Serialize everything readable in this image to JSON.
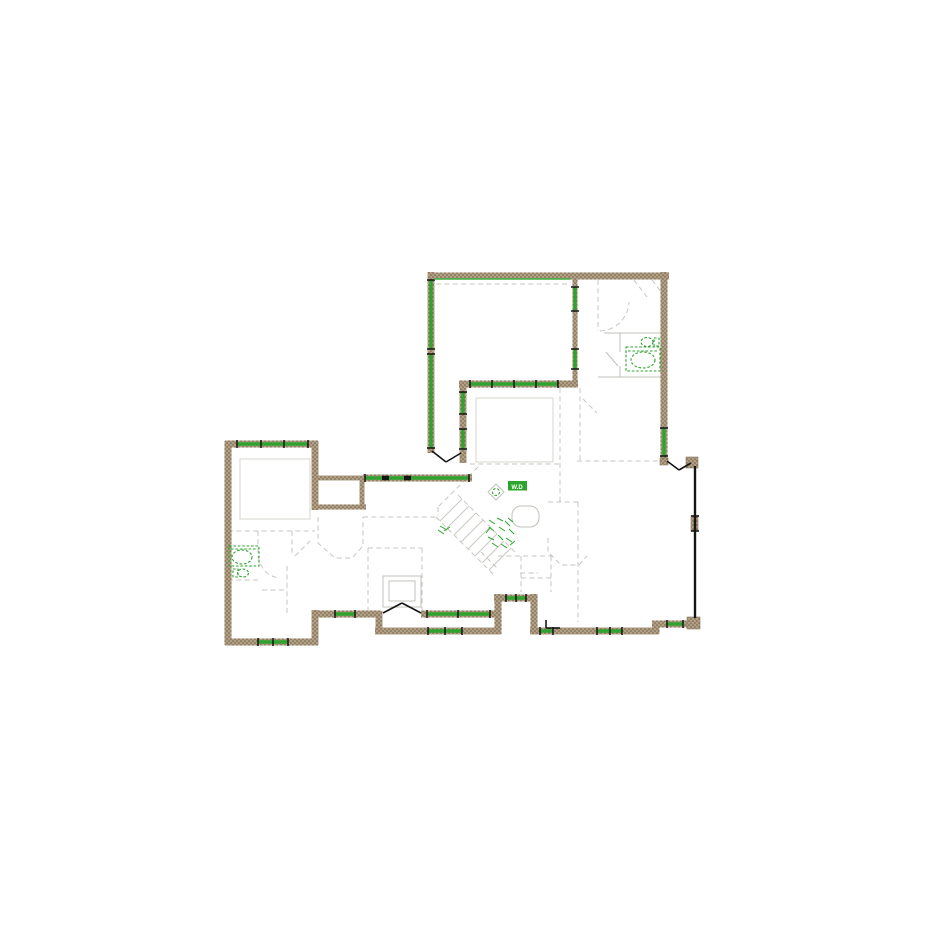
{
  "document": {
    "type": "architectural floor plan drawing",
    "description": "CAD floor plan with hatched exterior walls, green window and plumbing-fixture symbols, dashed gray interior partitions, stair run, porches and deck screen wall"
  },
  "colors": {
    "background": "#ffffff",
    "wall_fill": "#b2a084",
    "wall_speckle": "#6e5f49",
    "window_green": "#2ea32e",
    "fixture_green": "#2da42d",
    "interior_gray": "#c7c6c0",
    "door_black": "#151515"
  },
  "plan": {
    "labels": {
      "washer_dryer": "W.D"
    },
    "walls": [
      {
        "p": [
          428,
          276,
          669,
          276
        ]
      },
      {
        "p": [
          664,
          272,
          664,
          461
        ]
      },
      {
        "p": [
          431,
          272,
          431,
          453
        ]
      },
      {
        "p": [
          575,
          279,
          575,
          385
        ],
        "c": "wallt"
      },
      {
        "p": [
          459,
          384,
          578,
          384
        ]
      },
      {
        "p": [
          463,
          381,
          463,
          463
        ]
      },
      {
        "p": [
          225,
          444,
          318,
          444
        ]
      },
      {
        "p": [
          228,
          441,
          228,
          645
        ]
      },
      {
        "p": [
          225,
          642,
          318,
          642
        ]
      },
      {
        "p": [
          315,
          441,
          315,
          510
        ]
      },
      {
        "p": [
          313,
          478,
          366,
          478
        ],
        "c": "wallt"
      },
      {
        "p": [
          362,
          478,
          362,
          507
        ],
        "c": "wallt"
      },
      {
        "p": [
          313,
          507,
          366,
          507
        ],
        "c": "wallt"
      },
      {
        "p": [
          315,
          610,
          315,
          645
        ]
      },
      {
        "p": [
          313,
          614,
          381,
          614
        ]
      },
      {
        "p": [
          421,
          614,
          498,
          614
        ]
      },
      {
        "p": [
          379,
          611,
          379,
          634
        ]
      },
      {
        "p": [
          375,
          631,
          501,
          631
        ]
      },
      {
        "p": [
          498,
          594,
          498,
          634
        ]
      },
      {
        "p": [
          494,
          598,
          537,
          598
        ]
      },
      {
        "p": [
          534,
          594,
          534,
          634
        ]
      },
      {
        "p": [
          530,
          631,
          659,
          631
        ]
      },
      {
        "p": [
          656,
          622,
          656,
          634
        ]
      },
      {
        "p": [
          652,
          624,
          696,
          624
        ]
      },
      {
        "p": [
          363,
          478,
          472,
          478
        ]
      }
    ],
    "posts": [
      {
        "p": [
          686,
          457,
          12,
          11
        ]
      },
      {
        "p": [
          687,
          617,
          13,
          12
        ]
      },
      {
        "p": [
          691,
          516,
          7,
          15
        ]
      },
      {
        "p": [
          660,
          458,
          8,
          7
        ]
      }
    ],
    "windows": [
      {
        "p": [
          431,
          280,
          431,
          349
        ]
      },
      {
        "p": [
          431,
          354,
          431,
          448
        ]
      },
      {
        "p": [
          664,
          428,
          664,
          456
        ]
      },
      {
        "p": [
          575,
          287,
          575,
          311
        ]
      },
      {
        "p": [
          575,
          349,
          575,
          369
        ]
      },
      {
        "p": [
          463,
          392,
          463,
          414
        ]
      },
      {
        "p": [
          463,
          429,
          463,
          449
        ]
      },
      {
        "p": [
          470,
          384,
          558,
          384
        ]
      },
      {
        "p": [
          237,
          444,
          308,
          444
        ]
      },
      {
        "p": [
          258,
          642,
          288,
          642
        ]
      },
      {
        "p": [
          365,
          478,
          469,
          478
        ]
      },
      {
        "p": [
          335,
          614,
          355,
          614
        ]
      },
      {
        "p": [
          427,
          614,
          490,
          614
        ]
      },
      {
        "p": [
          428,
          631,
          462,
          631
        ]
      },
      {
        "p": [
          506,
          598,
          526,
          598
        ]
      },
      {
        "p": [
          540,
          631,
          553,
          631
        ]
      },
      {
        "p": [
          597,
          631,
          622,
          631
        ]
      },
      {
        "p": [
          667,
          624,
          683,
          624
        ]
      },
      {
        "p": [
          434,
          279,
          570,
          279
        ],
        "c": "win2",
        "cap": false
      }
    ],
    "ticks": [
      {
        "p": [
          492,
          380,
          492,
          388
        ]
      },
      {
        "p": [
          514,
          380,
          514,
          388
        ]
      },
      {
        "p": [
          536,
          380,
          536,
          388
        ]
      },
      {
        "p": [
          261,
          440,
          261,
          448
        ]
      },
      {
        "p": [
          284,
          440,
          284,
          448
        ]
      },
      {
        "p": [
          458,
          610,
          458,
          618
        ]
      },
      {
        "p": [
          445,
          627,
          445,
          635
        ]
      },
      {
        "p": [
          516,
          594,
          516,
          602
        ]
      },
      {
        "p": [
          610,
          627,
          610,
          635
        ]
      },
      {
        "p": [
          273,
          638,
          273,
          646
        ]
      },
      {
        "p": [
          382,
          478,
          389,
          478
        ],
        "c": "blk3"
      },
      {
        "p": [
          404,
          478,
          411,
          478
        ],
        "c": "blk3"
      }
    ],
    "blacks": [
      {
        "p": [
          695,
          466,
          695,
          618
        ],
        "c": "blk2",
        "n": "deck-screen-wall"
      },
      {
        "p": [
          432,
          451,
          446,
          462
        ],
        "n": "door-swing"
      },
      {
        "p": [
          446,
          462,
          461,
          453
        ],
        "n": "door-swing"
      },
      {
        "p": [
          667,
          461,
          679,
          470
        ],
        "n": "door-swing"
      },
      {
        "p": [
          679,
          470,
          691,
          463
        ],
        "n": "door-swing"
      },
      {
        "p": [
          383,
          613,
          402,
          603
        ],
        "n": "french-door-swing"
      },
      {
        "p": [
          402,
          603,
          421,
          613
        ],
        "n": "french-door-swing"
      },
      {
        "p": [
          546,
          620,
          546,
          628
        ],
        "n": "door-mark"
      },
      {
        "p": [
          546,
          628,
          560,
          628
        ],
        "n": "door-mark"
      },
      {
        "p": [
          691,
          516,
          699,
          516
        ],
        "n": "post-tick"
      },
      {
        "p": [
          691,
          531,
          699,
          531
        ],
        "n": "post-tick"
      }
    ],
    "dashes": [
      {
        "p": [
          436,
          284,
          570,
          284
        ]
      },
      {
        "p": [
          577,
          461,
          658,
          461
        ]
      },
      {
        "p": [
          470,
          464,
          560,
          464
        ]
      },
      {
        "p": [
          598,
          280,
          598,
          331
        ]
      },
      {
        "d": "M600,331 A30,30 0 0 0 629,302"
      },
      {
        "p": [
          634,
          280,
          647,
          297
        ]
      },
      {
        "p": [
          652,
          280,
          665,
          297
        ]
      },
      {
        "p": [
          580,
          388,
          580,
          460
        ]
      },
      {
        "p": [
          583,
          399,
          597,
          413
        ]
      },
      {
        "p": [
          478,
          467,
          438,
          507
        ]
      },
      {
        "p": [
          438,
          507,
          438,
          516
        ]
      },
      {
        "p": [
          436,
          517,
          494,
          575
        ]
      },
      {
        "p": [
          458,
          495,
          516,
          553
        ]
      },
      {
        "d": "M318,517 L318,543 L335,558 L352,558 L363,546 L363,517"
      },
      {
        "p": [
          363,
          517,
          436,
          517
        ]
      },
      {
        "p": [
          368,
          548,
          368,
          610
        ]
      },
      {
        "p": [
          422,
          548,
          422,
          610
        ]
      },
      {
        "p": [
          368,
          548,
          422,
          548
        ]
      },
      {
        "p": [
          498,
          556,
          553,
          556
        ]
      },
      {
        "p": [
          521,
          556,
          521,
          592
        ]
      },
      {
        "p": [
          551,
          556,
          551,
          592
        ]
      },
      {
        "p": [
          521,
          578,
          551,
          578
        ]
      },
      {
        "p": [
          481,
          552,
          498,
          569
        ]
      },
      {
        "p": [
          560,
          388,
          560,
          460
        ]
      },
      {
        "p": [
          560,
          463,
          560,
          502
        ]
      },
      {
        "p": [
          548,
          502,
          580,
          502
        ]
      },
      {
        "p": [
          578,
          502,
          578,
          545
        ]
      },
      {
        "d": "M548,538 L548,552 L561,565 L579,565 L587,556"
      },
      {
        "p": [
          578,
          545,
          578,
          622
        ]
      },
      {
        "p": [
          520,
          573,
          538,
          573
        ]
      },
      {
        "p": [
          228,
          531,
          315,
          531
        ]
      },
      {
        "p": [
          258,
          531,
          258,
          556
        ]
      },
      {
        "d": "M258,556 Q262,576 280,578"
      },
      {
        "p": [
          262,
          590,
          287,
          590
        ]
      },
      {
        "p": [
          287,
          566,
          287,
          613
        ]
      },
      {
        "p": [
          292,
          531,
          292,
          556
        ]
      },
      {
        "p": [
          295,
          556,
          310,
          541
        ]
      },
      {
        "p": [
          228,
          580,
          258,
          580
        ]
      }
    ],
    "lites": [
      {
        "p": [
          604,
          333,
          662,
          333
        ]
      },
      {
        "p": [
          620,
          333,
          620,
          352
        ]
      },
      {
        "p": [
          620,
          366,
          620,
          377
        ]
      },
      {
        "p": [
          598,
          377,
          662,
          377
        ]
      },
      {
        "p": [
          606,
          352,
          618,
          366
        ]
      }
    ],
    "treads": [
      {
        "p": [
          440,
          521,
          462,
          499
        ]
      },
      {
        "p": [
          447,
          528,
          469,
          506
        ]
      },
      {
        "p": [
          454,
          535,
          476,
          513
        ]
      },
      {
        "p": [
          461,
          542,
          483,
          520
        ]
      },
      {
        "p": [
          468,
          549,
          490,
          527
        ]
      },
      {
        "p": [
          475,
          556,
          497,
          534
        ]
      },
      {
        "p": [
          482,
          563,
          504,
          541
        ]
      },
      {
        "p": [
          489,
          570,
          511,
          548
        ]
      }
    ],
    "ceils": [
      {
        "r": [
          240,
          459,
          70,
          60
        ],
        "n": "tray-ceiling-outline"
      },
      {
        "r": [
          476,
          398,
          77,
          64
        ],
        "n": "tray-ceiling-outline"
      }
    ],
    "literects": [
      {
        "r": [
          383,
          576,
          38,
          31
        ],
        "n": "fireplace-outline"
      },
      {
        "r": [
          389,
          581,
          26,
          20
        ],
        "n": "firebox-outline"
      }
    ],
    "stadium": {
      "r": [
        512,
        506,
        27,
        21
      ],
      "rx": 9,
      "n": "kitchen-island-outline"
    },
    "fixtures": [
      {
        "t": "r",
        "c": "grnd",
        "r": [
          626,
          347,
          34,
          24
        ],
        "n": "bathtub"
      },
      {
        "t": "e",
        "c": "grnd",
        "e": [
          643,
          360,
          12,
          8
        ],
        "n": "bathtub-basin"
      },
      {
        "t": "l",
        "c": "grnd",
        "p": [
          628,
          351,
          658,
          351
        ],
        "n": "bathtub-ledge"
      },
      {
        "t": "e",
        "c": "grnd",
        "e": [
          647,
          342,
          6,
          4.5
        ],
        "n": "toilet-bowl"
      },
      {
        "t": "r",
        "c": "grnd",
        "r": [
          654,
          338,
          5,
          8
        ],
        "n": "toilet-tank"
      },
      {
        "t": "r",
        "c": "grnd",
        "r": [
          229,
          546,
          30,
          20
        ],
        "n": "bathtub"
      },
      {
        "t": "e",
        "c": "grnd",
        "e": [
          242,
          557,
          10,
          7
        ],
        "n": "bathtub-basin"
      },
      {
        "t": "l",
        "c": "grnd",
        "p": [
          231,
          549,
          257,
          549
        ],
        "n": "bathtub-ledge"
      },
      {
        "t": "e",
        "c": "grnd",
        "e": [
          243,
          573,
          5.5,
          4
        ],
        "n": "toilet-bowl"
      },
      {
        "t": "r",
        "c": "grnd",
        "r": [
          233,
          569,
          5,
          8
        ],
        "n": "toilet-tank"
      },
      {
        "t": "r",
        "c": "grnf",
        "r": [
          508,
          481,
          19,
          9.5
        ],
        "n": "washer-dryer-unit"
      },
      {
        "t": "p",
        "c": "lite",
        "d": "M488,492 L496,484 L504,492 L496,500 Z",
        "n": "laundry-sink"
      },
      {
        "t": "e",
        "c": "grnd",
        "e": [
          496,
          492,
          3.5,
          3.5
        ],
        "n": "laundry-sink-drain"
      }
    ],
    "scatter": [
      {
        "p": [
          489,
          520,
          495,
          524
        ]
      },
      {
        "p": [
          497,
          518,
          503,
          521
        ]
      },
      {
        "p": [
          505,
          521,
          510,
          526
        ]
      },
      {
        "p": [
          490,
          528,
          486,
          533
        ]
      },
      {
        "p": [
          499,
          527,
          505,
          531
        ]
      },
      {
        "p": [
          509,
          529,
          514,
          534
        ]
      },
      {
        "p": [
          488,
          537,
          494,
          540
        ]
      },
      {
        "p": [
          498,
          535,
          503,
          540
        ]
      },
      {
        "p": [
          506,
          538,
          512,
          542
        ]
      },
      {
        "p": [
          492,
          543,
          498,
          547
        ]
      },
      {
        "p": [
          501,
          544,
          507,
          548
        ]
      },
      {
        "p": [
          510,
          545,
          515,
          541
        ]
      },
      {
        "p": [
          494,
          531,
          489,
          527
        ]
      },
      {
        "p": [
          513,
          522,
          508,
          518
        ]
      },
      {
        "p": [
          440,
          526,
          447,
          530
        ]
      },
      {
        "p": [
          444,
          531,
          450,
          527
        ]
      },
      {
        "p": [
          438,
          530,
          444,
          534
        ]
      }
    ]
  }
}
